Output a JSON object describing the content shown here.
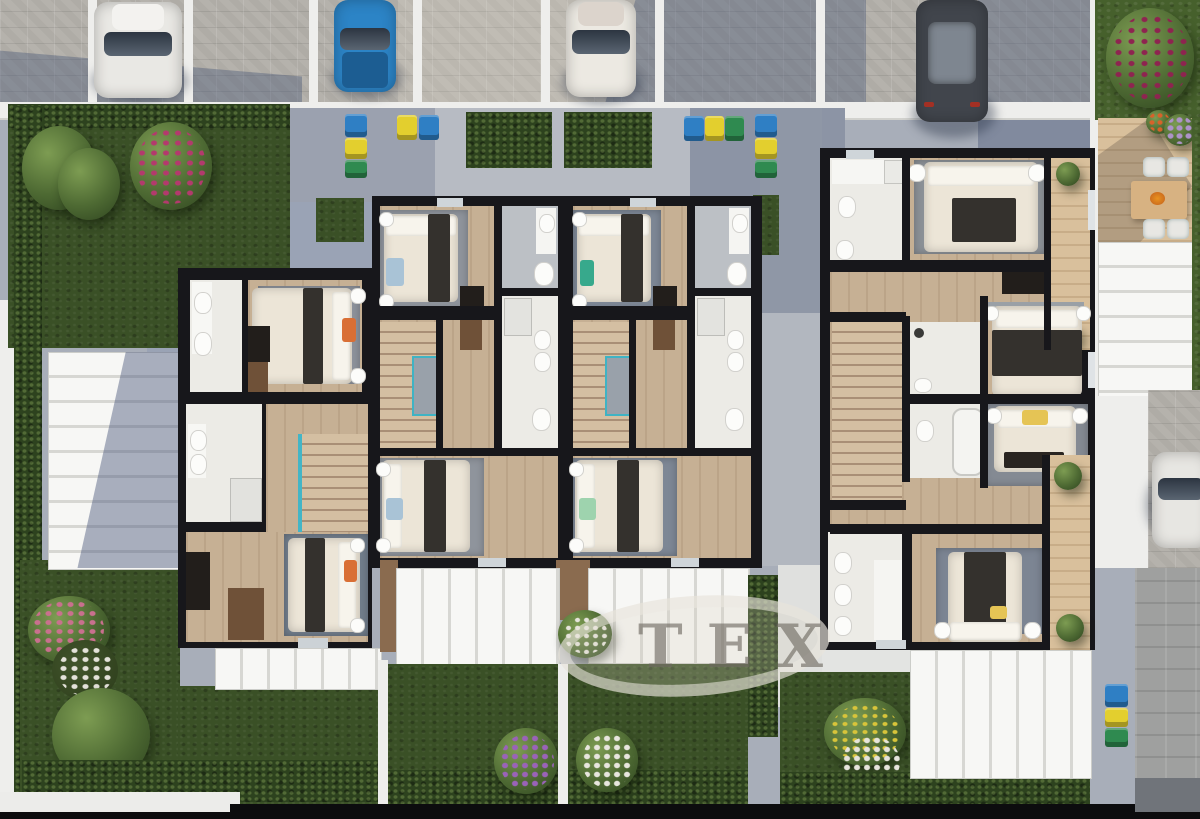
{
  "watermark": {
    "text": "TEX"
  },
  "scene": {
    "description": "Top-down 3D architectural site plan rendering of terraced houses with furnished floor plans, gardens and parking",
    "cars": [
      {
        "id": "car-1",
        "color": "white"
      },
      {
        "id": "car-2",
        "color": "blue"
      },
      {
        "id": "car-3",
        "color": "cream-white"
      },
      {
        "id": "car-4",
        "color": "dark-gray"
      },
      {
        "id": "car-5",
        "color": "white"
      }
    ],
    "recycling_bin_colors": [
      "blue",
      "yellow",
      "green"
    ],
    "flower_colors": [
      "pink",
      "magenta",
      "purple",
      "white",
      "yellow",
      "orange"
    ],
    "visible_rooms": [
      "bedroom",
      "bathroom",
      "staircase",
      "hallway",
      "terrace-dining"
    ],
    "palette": {
      "lawn": "#46602c",
      "hedge": "#2d421e",
      "paver": "#b5b2ac",
      "shadow_blue": "#46557a",
      "wall": "#17171b",
      "wood_floor": "#c6b094",
      "bath_floor": "#ecebe6",
      "canopy_white": "#f4f4f2",
      "terrace_wood": "#d9c09c",
      "glass_teal": "#3fb3c4",
      "accent_orange": "#d96f35",
      "accent_yellow": "#e5c455",
      "accent_mint": "#9ed3ae",
      "accent_blue": "#a9c3d6",
      "bin_blue": "#2f7fc4",
      "bin_yellow": "#e3cf2e",
      "bin_green": "#2f8a50",
      "car_blue": "#2c84c6"
    }
  }
}
